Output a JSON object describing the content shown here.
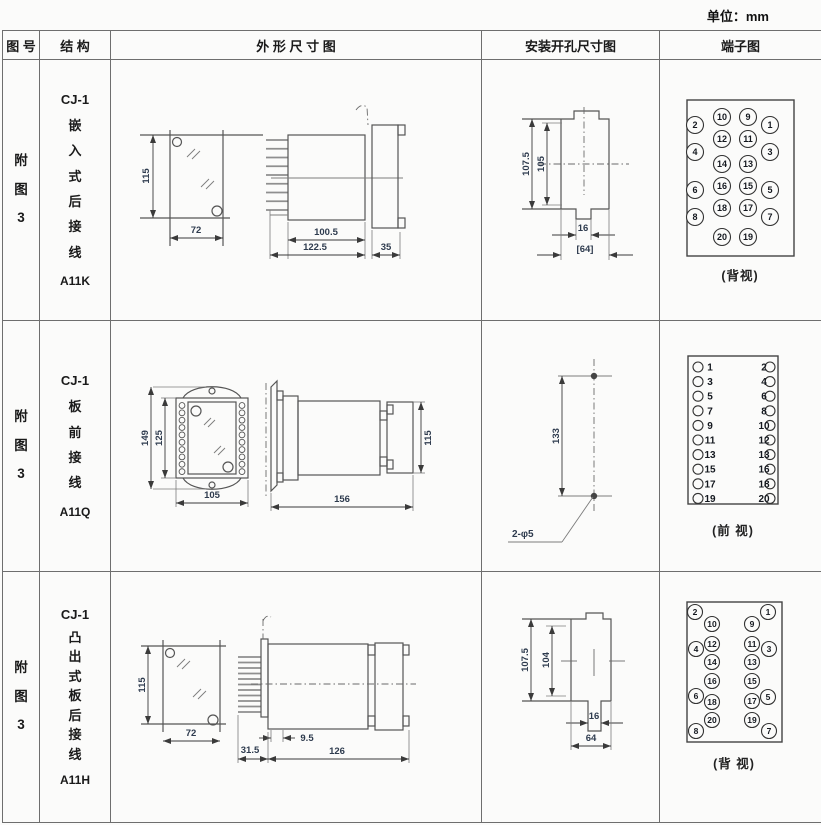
{
  "unit_label": "单位：mm",
  "header": {
    "fig": "图 号",
    "structure": "结 构",
    "outline": "外 形 尺 寸 图",
    "mounting": "安装开孔尺寸图",
    "terminal": "端子图"
  },
  "colors": {
    "dim_text": "#2e3b4e",
    "drawing_line": "#555555",
    "table_border": "#6e6e6e"
  },
  "rows": [
    {
      "fig_no": "附\n图\n3",
      "model": "CJ-1",
      "structure": "嵌\n入\n式\n后\n接\n线",
      "code": "A11K",
      "dims": {
        "front_h": "115",
        "front_w": "72",
        "body_d": "100.5",
        "total_d": "122.5",
        "flange_d": "35"
      },
      "mount": {
        "h1": "107.5",
        "h2": "105",
        "notch": "16",
        "width": "[64]"
      },
      "terminal_caption": "(背视)",
      "terminal_r": 8.5,
      "terminals": [
        {
          "n": "2",
          "x": 35,
          "y": 65
        },
        {
          "n": "10",
          "x": 62,
          "y": 57
        },
        {
          "n": "9",
          "x": 88,
          "y": 57
        },
        {
          "n": "1",
          "x": 110,
          "y": 65
        },
        {
          "n": "4",
          "x": 35,
          "y": 92
        },
        {
          "n": "12",
          "x": 62,
          "y": 79
        },
        {
          "n": "11",
          "x": 88,
          "y": 79
        },
        {
          "n": "3",
          "x": 110,
          "y": 92
        },
        {
          "n": "14",
          "x": 62,
          "y": 104
        },
        {
          "n": "13",
          "x": 88,
          "y": 104
        },
        {
          "n": "6",
          "x": 35,
          "y": 130
        },
        {
          "n": "16",
          "x": 62,
          "y": 126
        },
        {
          "n": "15",
          "x": 88,
          "y": 126
        },
        {
          "n": "5",
          "x": 110,
          "y": 130
        },
        {
          "n": "8",
          "x": 35,
          "y": 157
        },
        {
          "n": "18",
          "x": 62,
          "y": 148
        },
        {
          "n": "17",
          "x": 88,
          "y": 148
        },
        {
          "n": "7",
          "x": 110,
          "y": 157
        },
        {
          "n": "20",
          "x": 62,
          "y": 177
        },
        {
          "n": "19",
          "x": 88,
          "y": 177
        }
      ]
    },
    {
      "fig_no": "附\n图\n3",
      "model": "CJ-1",
      "structure": "板\n前\n接\n线",
      "code": "A11Q",
      "dims": {
        "front_h_outer": "149",
        "front_h_inner": "125",
        "front_w": "105",
        "side_len": "156",
        "side_h": "115"
      },
      "mount": {
        "pitch": "133",
        "holes": "2-φ5"
      },
      "terminal_caption": "(前 视)",
      "terminal_layout": {
        "y0": 46,
        "step": 14.6,
        "cxL": 38,
        "cxR": 110,
        "xL": 50,
        "xR": 104,
        "r": 5
      },
      "terminal_pairs": [
        [
          "1",
          "2"
        ],
        [
          "3",
          "4"
        ],
        [
          "5",
          "6"
        ],
        [
          "7",
          "8"
        ],
        [
          "9",
          "10"
        ],
        [
          "11",
          "12"
        ],
        [
          "13",
          "13"
        ],
        [
          "15",
          "16"
        ],
        [
          "17",
          "18"
        ],
        [
          "19",
          "20"
        ]
      ]
    },
    {
      "fig_no": "附\n图\n3",
      "model": "CJ-1",
      "structure": "凸\n出\n式\n板\n后\n接\n线",
      "code": "A11H",
      "dims": {
        "front_h": "115",
        "front_w": "72",
        "pin_d": "31.5",
        "stud_d": "9.5",
        "total_d": "126"
      },
      "mount": {
        "h1": "107.5",
        "h2": "104",
        "notch": "16",
        "width": "64"
      },
      "terminal_caption": "(背 视)",
      "terminal_r": 7.5,
      "terminals": [
        {
          "n": "2",
          "x": 35,
          "y": 40
        },
        {
          "n": "10",
          "x": 52,
          "y": 52
        },
        {
          "n": "9",
          "x": 92,
          "y": 52
        },
        {
          "n": "1",
          "x": 108,
          "y": 40
        },
        {
          "n": "4",
          "x": 36,
          "y": 77
        },
        {
          "n": "12",
          "x": 52,
          "y": 72
        },
        {
          "n": "11",
          "x": 92,
          "y": 72
        },
        {
          "n": "3",
          "x": 109,
          "y": 77
        },
        {
          "n": "14",
          "x": 52,
          "y": 90
        },
        {
          "n": "13",
          "x": 92,
          "y": 90
        },
        {
          "n": "16",
          "x": 52,
          "y": 109
        },
        {
          "n": "15",
          "x": 92,
          "y": 109
        },
        {
          "n": "6",
          "x": 36,
          "y": 124
        },
        {
          "n": "18",
          "x": 52,
          "y": 130
        },
        {
          "n": "17",
          "x": 92,
          "y": 129
        },
        {
          "n": "5",
          "x": 108,
          "y": 125
        },
        {
          "n": "20",
          "x": 52,
          "y": 148
        },
        {
          "n": "19",
          "x": 92,
          "y": 148
        },
        {
          "n": "8",
          "x": 36,
          "y": 159
        },
        {
          "n": "7",
          "x": 109,
          "y": 159
        }
      ]
    }
  ]
}
